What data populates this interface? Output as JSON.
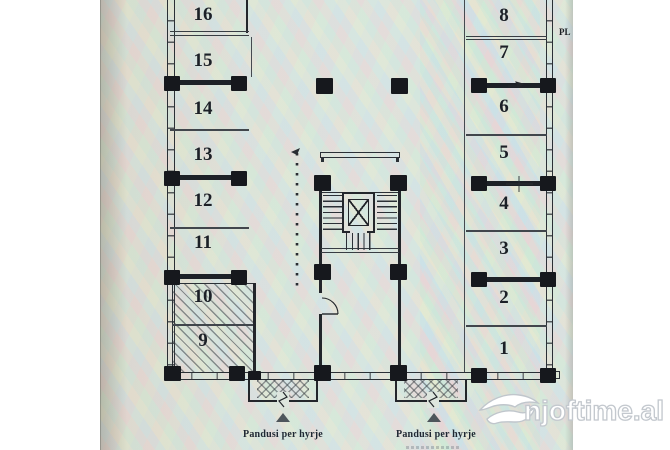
{
  "plan": {
    "left_rooms": [
      {
        "number": "16"
      },
      {
        "number": "15"
      },
      {
        "number": "14"
      },
      {
        "number": "13"
      },
      {
        "number": "12"
      },
      {
        "number": "11"
      },
      {
        "number": "10"
      },
      {
        "number": "9"
      }
    ],
    "right_rooms": [
      {
        "number": "8"
      },
      {
        "number": "7"
      },
      {
        "number": "6"
      },
      {
        "number": "5"
      },
      {
        "number": "4"
      },
      {
        "number": "3"
      },
      {
        "number": "2"
      },
      {
        "number": "1"
      }
    ],
    "entrances": [
      {
        "label": "Pandusi per hyrje"
      },
      {
        "label": "Pandusi per hyrje"
      }
    ],
    "corner_note": "PL",
    "colors": {
      "paper": "#dde5dd",
      "ink": "#23262b",
      "hatch": "#3e444a",
      "watermark_outline": "#c3c8ce",
      "watermark_fill": "#ffffff"
    }
  },
  "watermark": {
    "text": "njoftime.al",
    "logo": "swallow-bird-icon"
  }
}
